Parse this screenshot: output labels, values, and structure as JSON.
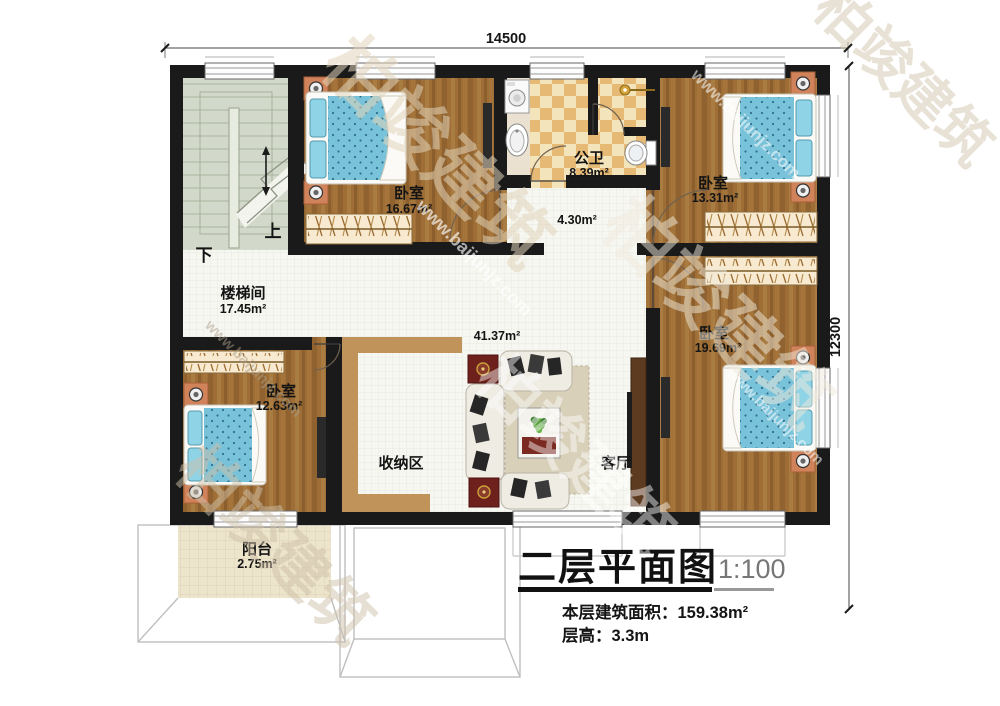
{
  "plan": {
    "dimension_top": "14500",
    "dimension_right": "12300",
    "stairs_up": "上",
    "stairs_down": "下"
  },
  "rooms": {
    "stairwell": {
      "name": "楼梯间",
      "area": "17.45m²"
    },
    "bedroom_top_left": {
      "name": "卧室",
      "area": "16.67m²"
    },
    "bathroom": {
      "name": "公卫",
      "area": "8.39m²"
    },
    "hallway": {
      "area": "4.30m²"
    },
    "bedroom_top_right": {
      "name": "卧室",
      "area": "13.31m²"
    },
    "bedroom_right": {
      "name": "卧室",
      "area": "19.69m²"
    },
    "living_room": {
      "name": "客厅",
      "area": "41.37m²"
    },
    "storage_area": {
      "name": "收纳区"
    },
    "bedroom_bottom_left": {
      "name": "卧室",
      "area": "12.63m²"
    },
    "balcony": {
      "name": "阳台",
      "area": "2.75m²"
    }
  },
  "title_block": {
    "title": "二层平面图",
    "scale": "1:100",
    "area_line": "本层建筑面积：159.38m²",
    "height_line": "层高：3.3m"
  },
  "watermark": {
    "brand": "柏竣建筑",
    "url": "www.baijunjz.com"
  },
  "colors": {
    "wall": "#1a1a1a",
    "wood": "#9c6c34",
    "checker_tan": "#e6ba74",
    "bed_blue": "#79c3da",
    "accent_tan": "#c0935a"
  }
}
